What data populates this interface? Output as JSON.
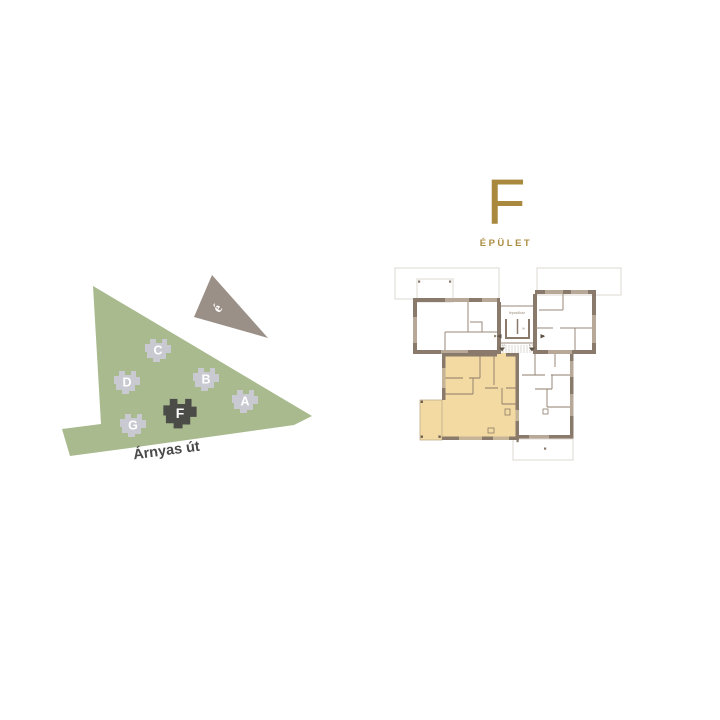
{
  "header": {
    "letter": "F",
    "label": "ÉPÜLET"
  },
  "site_map": {
    "street_label": "Árnyas út",
    "north_label": "é",
    "buildings": [
      {
        "letter": "A",
        "highlighted": false
      },
      {
        "letter": "B",
        "highlighted": false
      },
      {
        "letter": "C",
        "highlighted": false
      },
      {
        "letter": "D",
        "highlighted": false
      },
      {
        "letter": "F",
        "highlighted": true
      },
      {
        "letter": "G",
        "highlighted": false
      }
    ]
  },
  "floor_plan": {
    "stairwell_label": "lépcsőház",
    "lift_label": "lift",
    "unit_labels": [
      "F 1.1",
      "F 1.2"
    ]
  },
  "colors": {
    "accent_gold": "#a8893e",
    "site_green": "#a8ba8e",
    "building_gray": "#c8c9d1",
    "building_dark": "#4b4b47",
    "compass": "#9b9087",
    "unit_highlight": "#f3d9a2",
    "wall": "#8a7a6b",
    "window": "#b7a897",
    "terrace_outline": "#dcd8d2"
  }
}
